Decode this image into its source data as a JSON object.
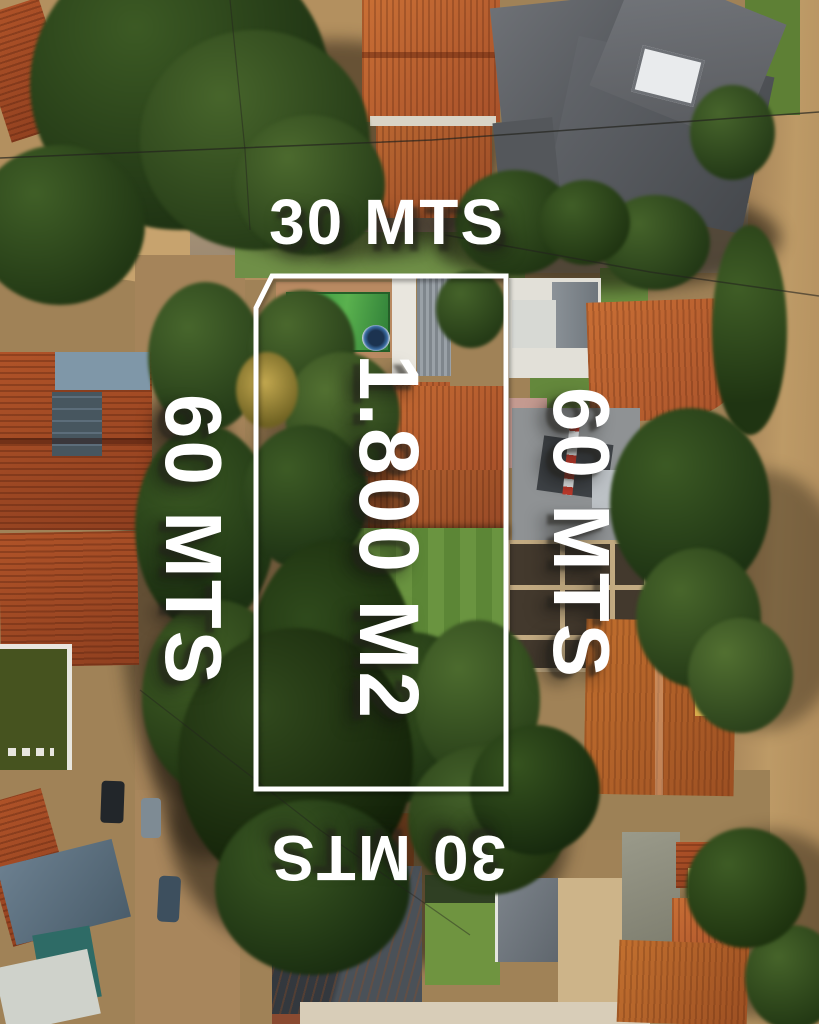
{
  "overlay": {
    "top_label": "30 MTS",
    "left_label": "60 MTS",
    "right_label": "60 MTS",
    "area_label": "1.800 M2",
    "bottom_label": "30 MTS",
    "text_color": "#ffffff",
    "boundary_color": "#ffffff",
    "boundary_shape": "rectangle with chamfered top-left corner"
  }
}
